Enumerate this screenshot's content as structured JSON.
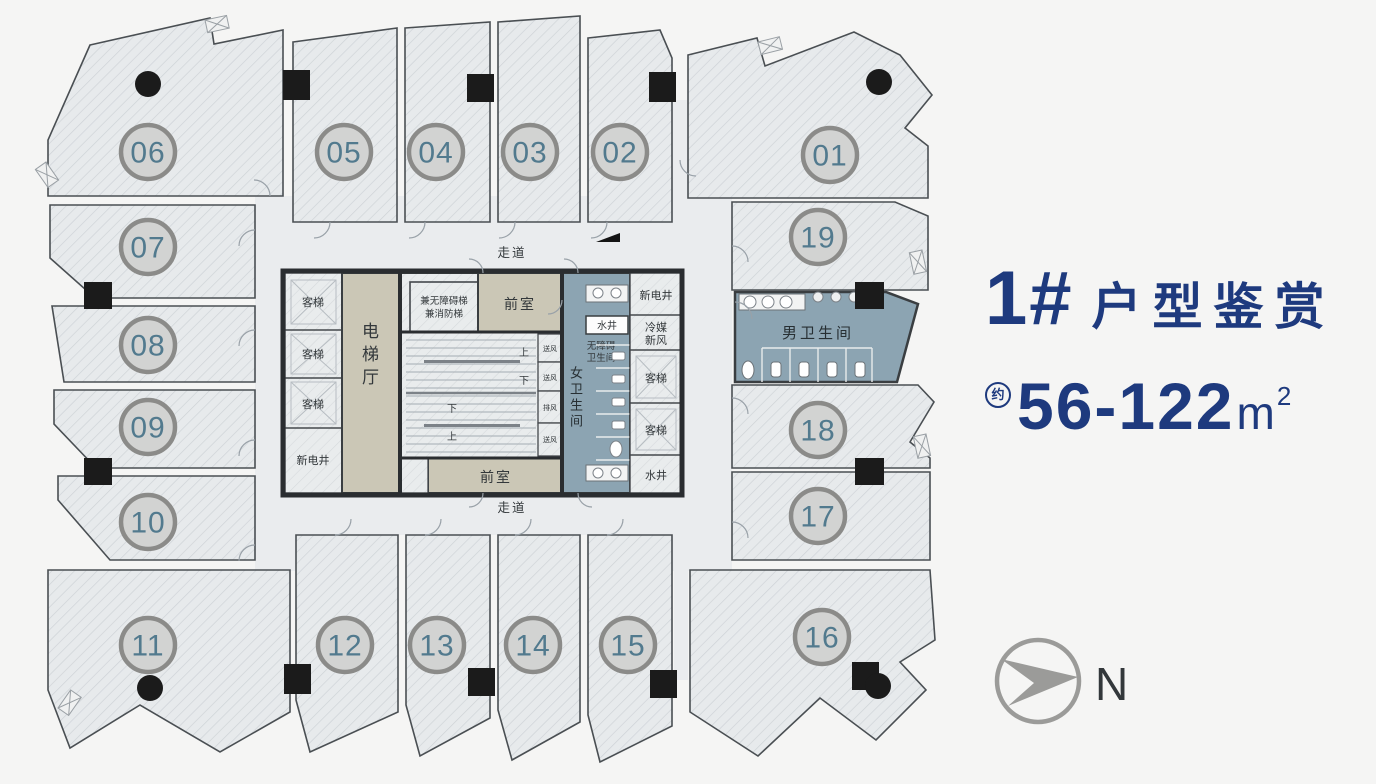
{
  "page": {
    "background": "#f5f5f4"
  },
  "title": {
    "building": "1#",
    "suffix": "户型鉴赏",
    "approx_label": "约",
    "area_range": "56-122",
    "area_unit": "m",
    "area_sup": "2"
  },
  "compass": {
    "north_label": "N"
  },
  "corridor": {
    "label": "走道"
  },
  "units": [
    {
      "label": "01"
    },
    {
      "label": "02"
    },
    {
      "label": "03"
    },
    {
      "label": "04"
    },
    {
      "label": "05"
    },
    {
      "label": "06"
    },
    {
      "label": "07"
    },
    {
      "label": "08"
    },
    {
      "label": "09"
    },
    {
      "label": "10"
    },
    {
      "label": "11"
    },
    {
      "label": "12"
    },
    {
      "label": "13"
    },
    {
      "label": "14"
    },
    {
      "label": "15"
    },
    {
      "label": "16"
    },
    {
      "label": "17"
    },
    {
      "label": "18"
    },
    {
      "label": "19"
    }
  ],
  "core": {
    "elevator_hall": "电梯厅",
    "passenger_elevator": "客梯",
    "new_electric_shaft": "新电井",
    "water_shaft": "水井",
    "refrigerant_fresh_air_line1": "冷媒",
    "refrigerant_fresh_air_line2": "新风",
    "fire_stair_line1": "兼无障碍梯",
    "fire_stair_line2": "兼消防梯",
    "front_room": "前室",
    "up": "上",
    "down": "下",
    "supply_air": "送风",
    "exhaust_air": "排风",
    "accessible_wc_line1": "无障碍",
    "accessible_wc_line2": "卫生间",
    "womens_wc": "女卫生间",
    "mens_wc": "男卫生间"
  },
  "colors": {
    "title_navy": "#1e3a7e",
    "unit_number_teal": "#527a8e",
    "core_beige": "#cbc7b6",
    "restroom_blue": "#8ca4b2",
    "column_black": "#1b1b1b",
    "compass_gray": "#9b9b99"
  }
}
